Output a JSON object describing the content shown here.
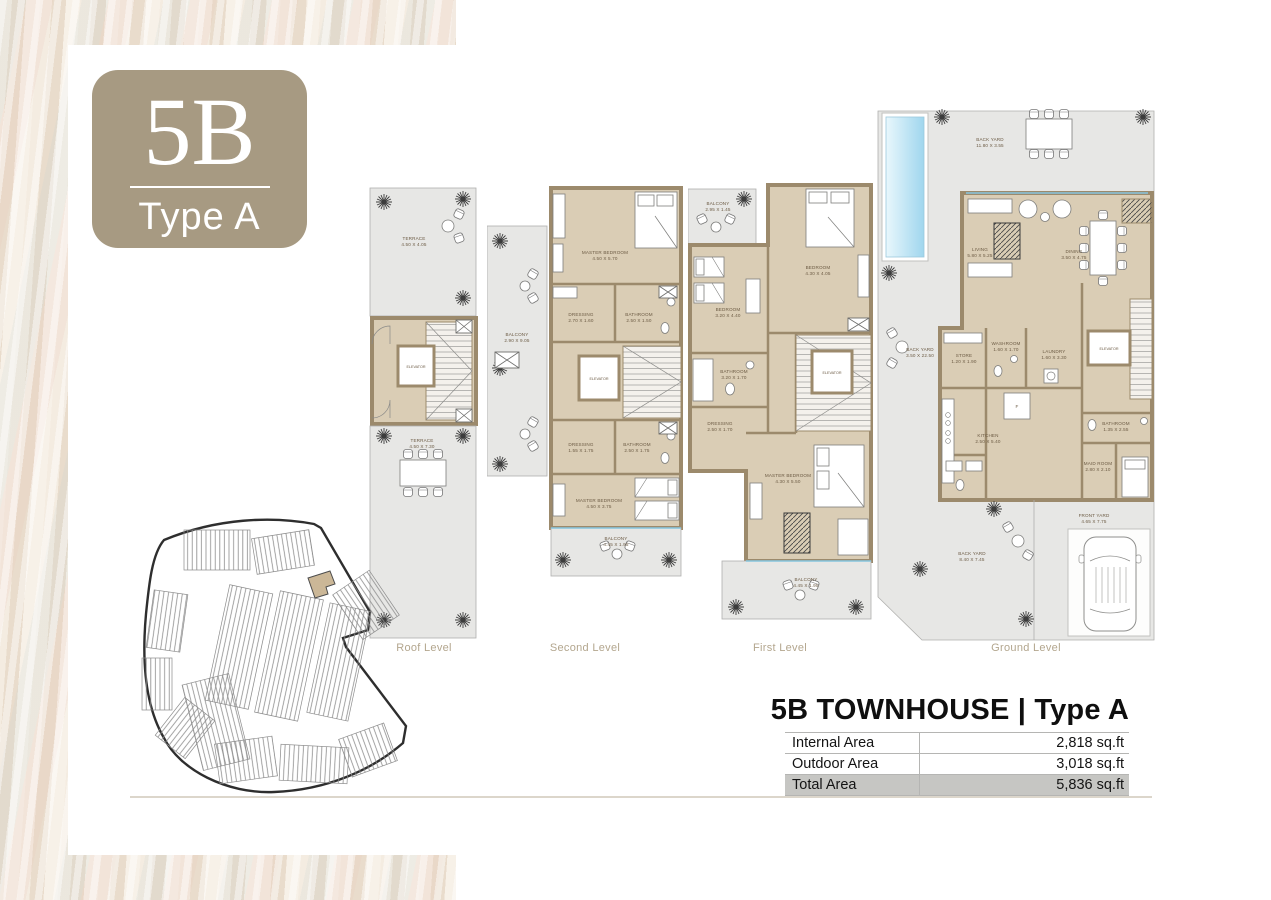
{
  "badge": {
    "code": "5B",
    "type": "Type A"
  },
  "plans": {
    "roof": {
      "caption": "Roof Level",
      "rooms": {
        "terrace_top": {
          "name": "TERRACE",
          "dims": "4.50 X 4.05"
        },
        "terrace_bottom": {
          "name": "TERRACE",
          "dims": "4.50 X 7.30"
        },
        "elevator": {
          "name": "ELEVATOR"
        }
      }
    },
    "second": {
      "caption": "Second Level",
      "rooms": {
        "balcony_side": {
          "name": "BALCONY",
          "dims": "2.90 X 9.05"
        },
        "master_top": {
          "name": "MASTER BEDROOM",
          "dims": "4.50 X 5.70"
        },
        "dressing_top": {
          "name": "DRESSING",
          "dims": "2.70 X 1.60"
        },
        "bathroom_top": {
          "name": "BATHROOM",
          "dims": "2.50 X 1.50"
        },
        "elevator": {
          "name": "ELEVATOR"
        },
        "dressing_bottom": {
          "name": "DRESSING",
          "dims": "1.55 X 1.75"
        },
        "bathroom_bottom": {
          "name": "BATHROOM",
          "dims": "2.50 X 1.75"
        },
        "master_bottom": {
          "name": "MASTER BEDROOM",
          "dims": "4.50 X 3.75"
        },
        "balcony_bottom": {
          "name": "BALCONY",
          "dims": "4.45 X 1.95"
        }
      }
    },
    "first": {
      "caption": "First Level",
      "rooms": {
        "balcony_top": {
          "name": "BALCONY",
          "dims": "2.95 X 1.45"
        },
        "bedroom_left": {
          "name": "BEDROOM",
          "dims": "3.20 X 4.40"
        },
        "bedroom_right": {
          "name": "BEDROOM",
          "dims": "4.30 X 4.05"
        },
        "bathroom": {
          "name": "BATHROOM",
          "dims": "3.20 X 1.70"
        },
        "dressing": {
          "name": "DRESSING",
          "dims": "2.50 X 1.70"
        },
        "elevator": {
          "name": "ELEVATOR"
        },
        "master": {
          "name": "MASTER BEDROOM",
          "dims": "4.30 X 5.50"
        },
        "balcony_bottom": {
          "name": "BALCONY",
          "dims": "4.45 X 1.95"
        }
      }
    },
    "ground": {
      "caption": "Ground Level",
      "rooms": {
        "back_yard_top": {
          "name": "BACK YARD",
          "dims": "11.80 X 3.55"
        },
        "back_yard_side": {
          "name": "BACK YARD",
          "dims": "3.50 X 22.50"
        },
        "back_yard_main": {
          "name": "BACK YARD",
          "dims": "8.40 X 7.45"
        },
        "front_yard": {
          "name": "FRONT YARD",
          "dims": "4.65 X 7.75"
        },
        "living": {
          "name": "LIVING",
          "dims": "5.80 X 5.25"
        },
        "dining": {
          "name": "DINING",
          "dims": "3.50 X 4.75"
        },
        "store": {
          "name": "STORE",
          "dims": "1.20 X 1.90"
        },
        "washroom": {
          "name": "WASHROOM",
          "dims": "1.60 X 1.70"
        },
        "laundry": {
          "name": "LAUNDRY",
          "dims": "1.60 X 3.30"
        },
        "kitchen": {
          "name": "KITCHEN",
          "dims": "2.50 X 5.40"
        },
        "fridge": {
          "name": "F"
        },
        "elevator": {
          "name": "ELEVATOR"
        },
        "bathroom": {
          "name": "BATHROOM",
          "dims": "1.35 X 2.55"
        },
        "maid_room": {
          "name": "MAID ROOM",
          "dims": "2.80 X 2.10"
        }
      }
    }
  },
  "summary": {
    "title": "5B TOWNHOUSE | Type A",
    "rows": [
      {
        "label": "Internal Area",
        "value": "2,818 sq.ft"
      },
      {
        "label": "Outdoor Area",
        "value": "3,018 sq.ft"
      },
      {
        "label": "Total Area",
        "value": "5,836 sq.ft"
      }
    ]
  },
  "colors": {
    "badge": "#a79a82",
    "plan_interior": "#dacdb5",
    "plan_wall": "#9c8a6c",
    "outdoor_area": "#e7e7e5",
    "pool_water": "#aadcf0",
    "caption_text": "#b3a68e",
    "total_row_bg": "#c6c6c3",
    "texture_base": "#ece1d3"
  }
}
